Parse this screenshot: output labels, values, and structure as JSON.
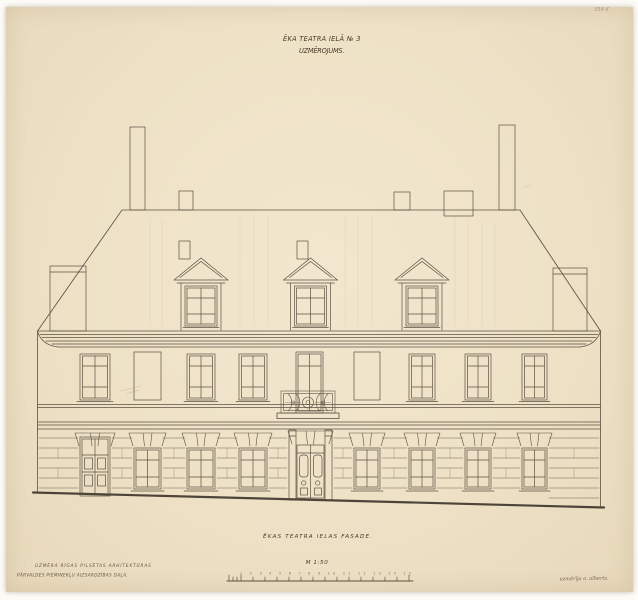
{
  "sheet": {
    "corner_note": "354 Ķ",
    "title": {
      "line1": "ĒKA TEATRA IELĀ № 3",
      "line2": "UZMĒROJUMS."
    },
    "caption": "ĒKAS TEATRA IELAS FASADE.",
    "scale": {
      "label": "M 1:50",
      "tick_numbers": "1 2 3 4 5 6 7 8 9 10 11 12 13 14 15"
    },
    "stamp": {
      "line1": "UZMĒRA RĪGAS PILSĒTAS ARHITEKTŪRAS",
      "line2": "PĀRVALDES PIEMINEKĻU AIZSARDZĪBAS DAĻA."
    },
    "signature": "uzmērīja a. alberts.",
    "colors": {
      "paper": "#eee1c6",
      "ink": "#4b4134",
      "pencil": "#9a8b71",
      "ground_line": "#3c332a"
    }
  }
}
